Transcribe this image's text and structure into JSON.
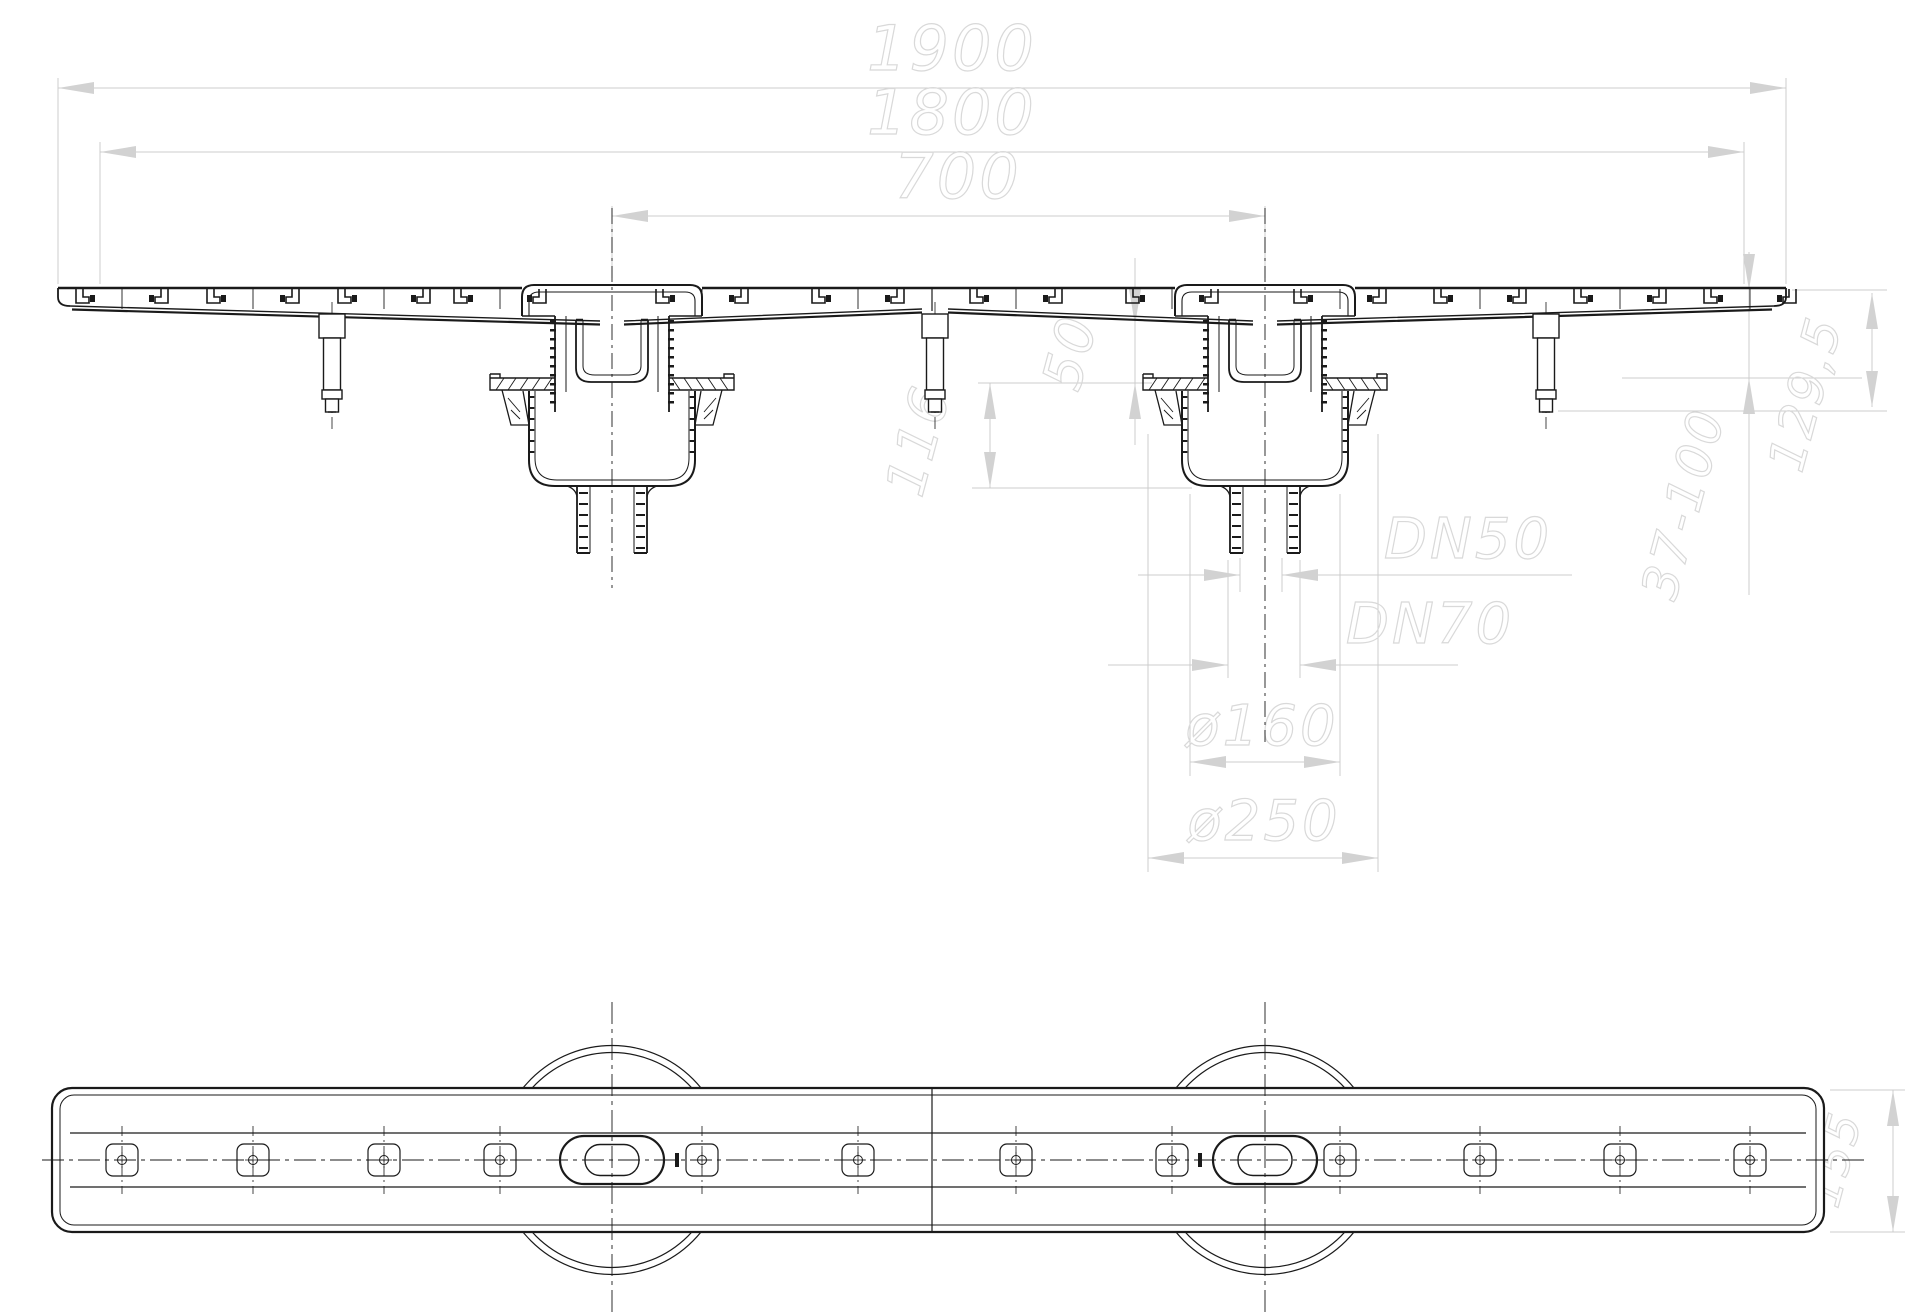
{
  "drawing": {
    "type": "technical-drawing",
    "colors": {
      "line": "#1a1a1a",
      "dimension_lines": "#cccccc",
      "dimension_text": "#d9d9d9",
      "background": "#ffffff"
    },
    "dims": {
      "len_total": "1900",
      "len_body": "1800",
      "outlet_spacing": "700",
      "h_channel": "50",
      "h_trap": "116",
      "outlet_small": "DN50",
      "outlet_large": "DN70",
      "dia_flange": "ø160",
      "dia_body": "ø250",
      "h_total": "129,5",
      "foot_range": "37-100",
      "body_width": "155"
    }
  }
}
